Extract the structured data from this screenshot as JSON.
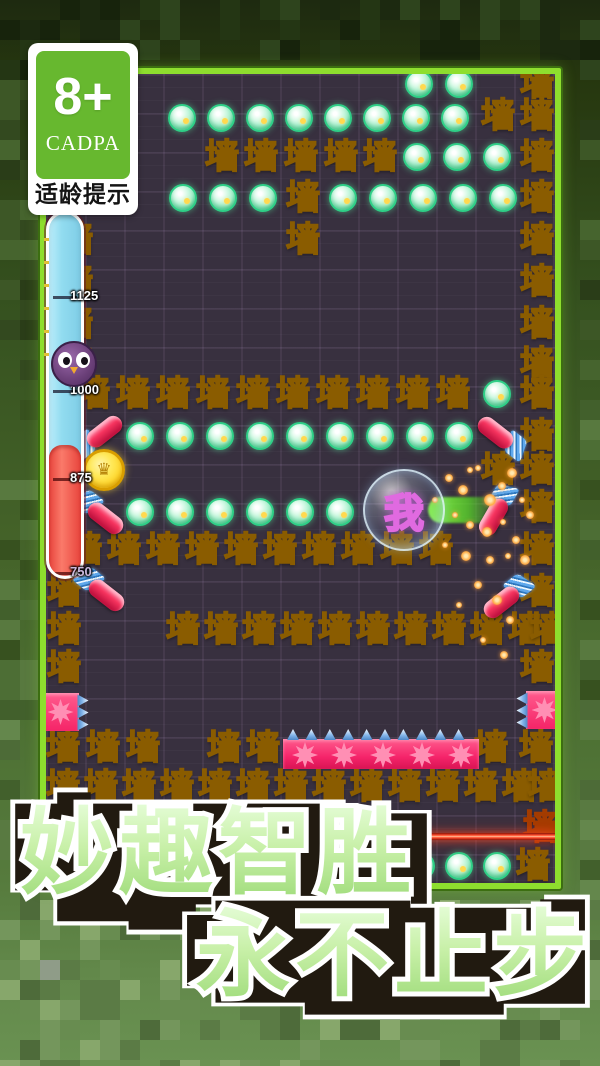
{
  "badge": {
    "rating": "8+",
    "org": "CADPA",
    "caption": "适龄提示"
  },
  "banner": {
    "line1": "妙趣智胜",
    "line2": "永不止步"
  },
  "hud": {
    "bar": {
      "cyan_color": "#92dcf0",
      "red_color": "#f4544a",
      "ticks": [
        {
          "y": 296,
          "label": "1125",
          "color": "#ffffff"
        },
        {
          "y": 390,
          "label": "1000",
          "color": "#ffffff"
        },
        {
          "y": 478,
          "label": "875",
          "color": "#ffffff"
        },
        {
          "y": 572,
          "label": "750",
          "color": "#cbb8dc"
        }
      ]
    },
    "owl": {
      "x": 72,
      "y": 362
    }
  },
  "board": {
    "origin": {
      "x": 46,
      "y": 74
    },
    "wall_char": "墙",
    "accent_colors": {
      "wall": "#ffc929",
      "gem": "#5fdca0",
      "spike": "#f5246a",
      "laser": "#ff4a2a",
      "border": "#8ede2e"
    },
    "player": {
      "x": 404,
      "y": 510,
      "label": "我"
    },
    "coin": {
      "x": 104,
      "y": 470,
      "symbol": "♛"
    },
    "laser": {
      "x1": 405,
      "x2": 557,
      "y": 836
    },
    "trail": {
      "x": 428,
      "y": 510,
      "length": 74
    },
    "walls": [
      [
        537,
        84
      ],
      [
        498,
        116
      ],
      [
        537,
        116
      ],
      [
        222,
        157
      ],
      [
        261,
        157
      ],
      [
        301,
        157
      ],
      [
        341,
        157
      ],
      [
        380,
        157
      ],
      [
        537,
        157
      ],
      [
        303,
        198
      ],
      [
        537,
        198
      ],
      [
        76,
        240
      ],
      [
        303,
        240
      ],
      [
        537,
        240
      ],
      [
        76,
        282
      ],
      [
        537,
        282
      ],
      [
        76,
        324
      ],
      [
        537,
        324
      ],
      [
        76,
        364
      ],
      [
        537,
        364
      ],
      [
        93,
        394
      ],
      [
        133,
        394
      ],
      [
        173,
        394
      ],
      [
        213,
        394
      ],
      [
        253,
        394
      ],
      [
        293,
        394
      ],
      [
        333,
        394
      ],
      [
        373,
        394
      ],
      [
        413,
        394
      ],
      [
        453,
        394
      ],
      [
        537,
        394
      ],
      [
        537,
        436
      ],
      [
        498,
        470
      ],
      [
        537,
        470
      ],
      [
        537,
        508
      ],
      [
        85,
        550
      ],
      [
        124,
        550
      ],
      [
        163,
        550
      ],
      [
        202,
        550
      ],
      [
        241,
        550
      ],
      [
        280,
        550
      ],
      [
        319,
        550
      ],
      [
        358,
        550
      ],
      [
        397,
        550
      ],
      [
        436,
        550
      ],
      [
        537,
        550
      ],
      [
        64,
        592
      ],
      [
        537,
        592
      ],
      [
        64,
        630
      ],
      [
        183,
        630
      ],
      [
        221,
        630
      ],
      [
        259,
        630
      ],
      [
        297,
        630
      ],
      [
        335,
        630
      ],
      [
        373,
        630
      ],
      [
        411,
        630
      ],
      [
        449,
        630
      ],
      [
        487,
        630
      ],
      [
        525,
        630
      ],
      [
        547,
        630
      ],
      [
        64,
        668
      ],
      [
        537,
        668
      ],
      [
        63,
        748
      ],
      [
        103,
        748
      ],
      [
        143,
        748
      ],
      [
        224,
        748
      ],
      [
        263,
        748
      ],
      [
        491,
        748
      ],
      [
        536,
        748
      ],
      [
        63,
        787
      ],
      [
        101,
        787
      ],
      [
        139,
        787
      ],
      [
        177,
        787
      ],
      [
        215,
        787
      ],
      [
        253,
        787
      ],
      [
        291,
        787
      ],
      [
        329,
        787
      ],
      [
        367,
        787
      ],
      [
        405,
        787
      ],
      [
        443,
        787
      ],
      [
        481,
        787
      ],
      [
        519,
        787
      ],
      [
        545,
        787
      ],
      [
        533,
        866
      ]
    ],
    "tinted_walls": [
      [
        540,
        828
      ]
    ],
    "gems": [
      [
        419,
        84
      ],
      [
        459,
        84
      ],
      [
        182,
        118
      ],
      [
        221,
        118
      ],
      [
        260,
        118
      ],
      [
        299,
        118
      ],
      [
        338,
        118
      ],
      [
        377,
        118
      ],
      [
        416,
        118
      ],
      [
        455,
        118
      ],
      [
        417,
        157
      ],
      [
        457,
        157
      ],
      [
        497,
        157
      ],
      [
        183,
        198
      ],
      [
        223,
        198
      ],
      [
        263,
        198
      ],
      [
        343,
        198
      ],
      [
        383,
        198
      ],
      [
        423,
        198
      ],
      [
        463,
        198
      ],
      [
        503,
        198
      ],
      [
        497,
        394
      ],
      [
        140,
        436
      ],
      [
        180,
        436
      ],
      [
        220,
        436
      ],
      [
        260,
        436
      ],
      [
        300,
        436
      ],
      [
        340,
        436
      ],
      [
        380,
        436
      ],
      [
        420,
        436
      ],
      [
        459,
        436
      ],
      [
        140,
        512
      ],
      [
        180,
        512
      ],
      [
        220,
        512
      ],
      [
        260,
        512
      ],
      [
        300,
        512
      ],
      [
        340,
        512
      ],
      [
        421,
        866
      ],
      [
        459,
        866
      ],
      [
        497,
        866
      ]
    ],
    "darts": [
      {
        "x": 99,
        "y": 436,
        "rot": -38,
        "flip": false
      },
      {
        "x": 501,
        "y": 437,
        "rot": 38,
        "flip": true
      },
      {
        "x": 100,
        "y": 514,
        "rot": 38,
        "flip": false
      },
      {
        "x": 497,
        "y": 511,
        "rot": -60,
        "flip": true
      },
      {
        "x": 101,
        "y": 591,
        "rot": 38,
        "flip": false
      },
      {
        "x": 507,
        "y": 598,
        "rot": -38,
        "flip": true
      }
    ],
    "spike_blocks": [
      {
        "x": 60,
        "y": 712,
        "dir": "right"
      },
      {
        "x": 544,
        "y": 710,
        "dir": "left"
      }
    ],
    "spike_strip": {
      "x": 283,
      "y": 729,
      "width": 196,
      "height": 40,
      "spike_count": 10,
      "burst_count": 5
    },
    "sparks": [
      [
        449,
        478,
        4
      ],
      [
        463,
        490,
        5
      ],
      [
        478,
        468,
        3
      ],
      [
        490,
        500,
        6
      ],
      [
        502,
        486,
        4
      ],
      [
        512,
        473,
        5
      ],
      [
        522,
        500,
        3
      ],
      [
        455,
        515,
        3
      ],
      [
        470,
        525,
        4
      ],
      [
        487,
        532,
        5
      ],
      [
        503,
        522,
        3
      ],
      [
        516,
        540,
        4
      ],
      [
        445,
        545,
        3
      ],
      [
        466,
        556,
        5
      ],
      [
        490,
        560,
        4
      ],
      [
        508,
        556,
        3
      ],
      [
        478,
        585,
        4
      ],
      [
        497,
        600,
        5
      ],
      [
        459,
        605,
        3
      ],
      [
        510,
        620,
        4
      ],
      [
        483,
        640,
        3
      ],
      [
        504,
        655,
        4
      ],
      [
        470,
        470,
        3
      ],
      [
        435,
        500,
        3
      ],
      [
        530,
        515,
        4
      ],
      [
        525,
        560,
        5
      ]
    ]
  }
}
